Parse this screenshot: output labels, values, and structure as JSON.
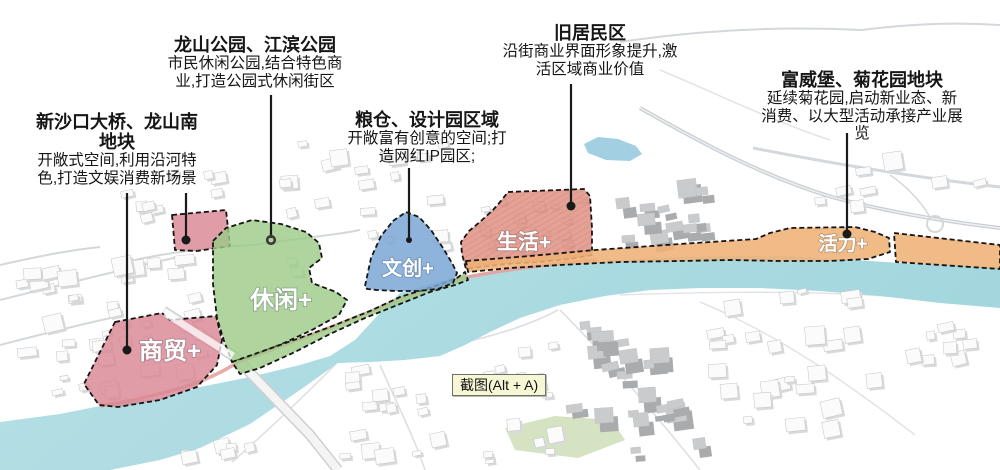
{
  "annotations": [
    {
      "id": "xinshakou",
      "title_lines": [
        "新沙口大桥、龙山南",
        "地块"
      ],
      "body_lines": [
        "开敞式空间,利用沿河特",
        "色,打造文娱消费新场景"
      ]
    },
    {
      "id": "longshan-park",
      "title_lines": [
        "龙山公园、江滨公园"
      ],
      "body_lines": [
        "市民休闲公园,结合特色商",
        "业,打造公园式休闲街区"
      ]
    },
    {
      "id": "liangcang",
      "title_lines": [
        "粮仓、设计园区域"
      ],
      "body_lines": [
        "开敞富有创意的空间;打",
        "造网红IP园区;"
      ]
    },
    {
      "id": "jiujuminqu",
      "title_lines": [
        "旧居民区"
      ],
      "body_lines": [
        "沿街商业界面形象提升,激",
        "活区域商业价值"
      ]
    },
    {
      "id": "fuweibao",
      "title_lines": [
        "富威堡、菊花园地块"
      ],
      "body_lines": [
        "延续菊花园,启动新业态、新",
        "消费、以大型活动承接产业展",
        "览"
      ]
    }
  ],
  "zones": {
    "commerce": {
      "label": "商贸+"
    },
    "leisure": {
      "label": "休闲+"
    },
    "culture": {
      "label": "文创+"
    },
    "life": {
      "label": "生活+"
    },
    "vitality": {
      "label": "活力+"
    }
  },
  "map_colors": {
    "commerce_pink": "#d98795",
    "leisure_green": "#9ecb88",
    "culture_blue": "#7aa7d6",
    "life_red": "#dd8a7a",
    "vitality_orange": "#efb277",
    "river_blue": "#abdbe2",
    "lake_blue": "#a3cfe3",
    "shore_salmon": "#e6a19b",
    "field_green": "#d5e3c3"
  },
  "tooltip": {
    "label": "截图(Alt + A)"
  }
}
